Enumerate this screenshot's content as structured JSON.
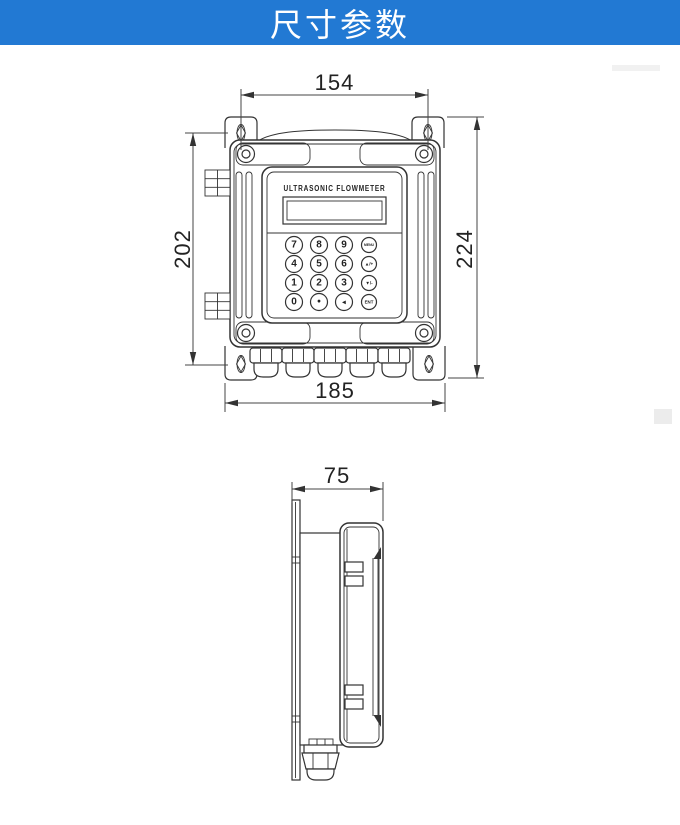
{
  "header": {
    "title": "尺寸参数"
  },
  "colors": {
    "banner_bg": "#2279d3",
    "banner_text": "#ffffff",
    "line": "#333333",
    "background": "#ffffff"
  },
  "front_view": {
    "device_label": "ULTRASONIC FLOWMETER",
    "dim_top": "154",
    "dim_left": "202",
    "dim_right": "224",
    "dim_bottom": "185",
    "keypad": [
      [
        "7",
        "8",
        "9",
        "MENU"
      ],
      [
        "4",
        "5",
        "6",
        "▲/+"
      ],
      [
        "1",
        "2",
        "3",
        "▼/-"
      ],
      [
        "0",
        "•",
        "◀",
        "ENT"
      ]
    ]
  },
  "side_view": {
    "dim_depth": "75"
  }
}
